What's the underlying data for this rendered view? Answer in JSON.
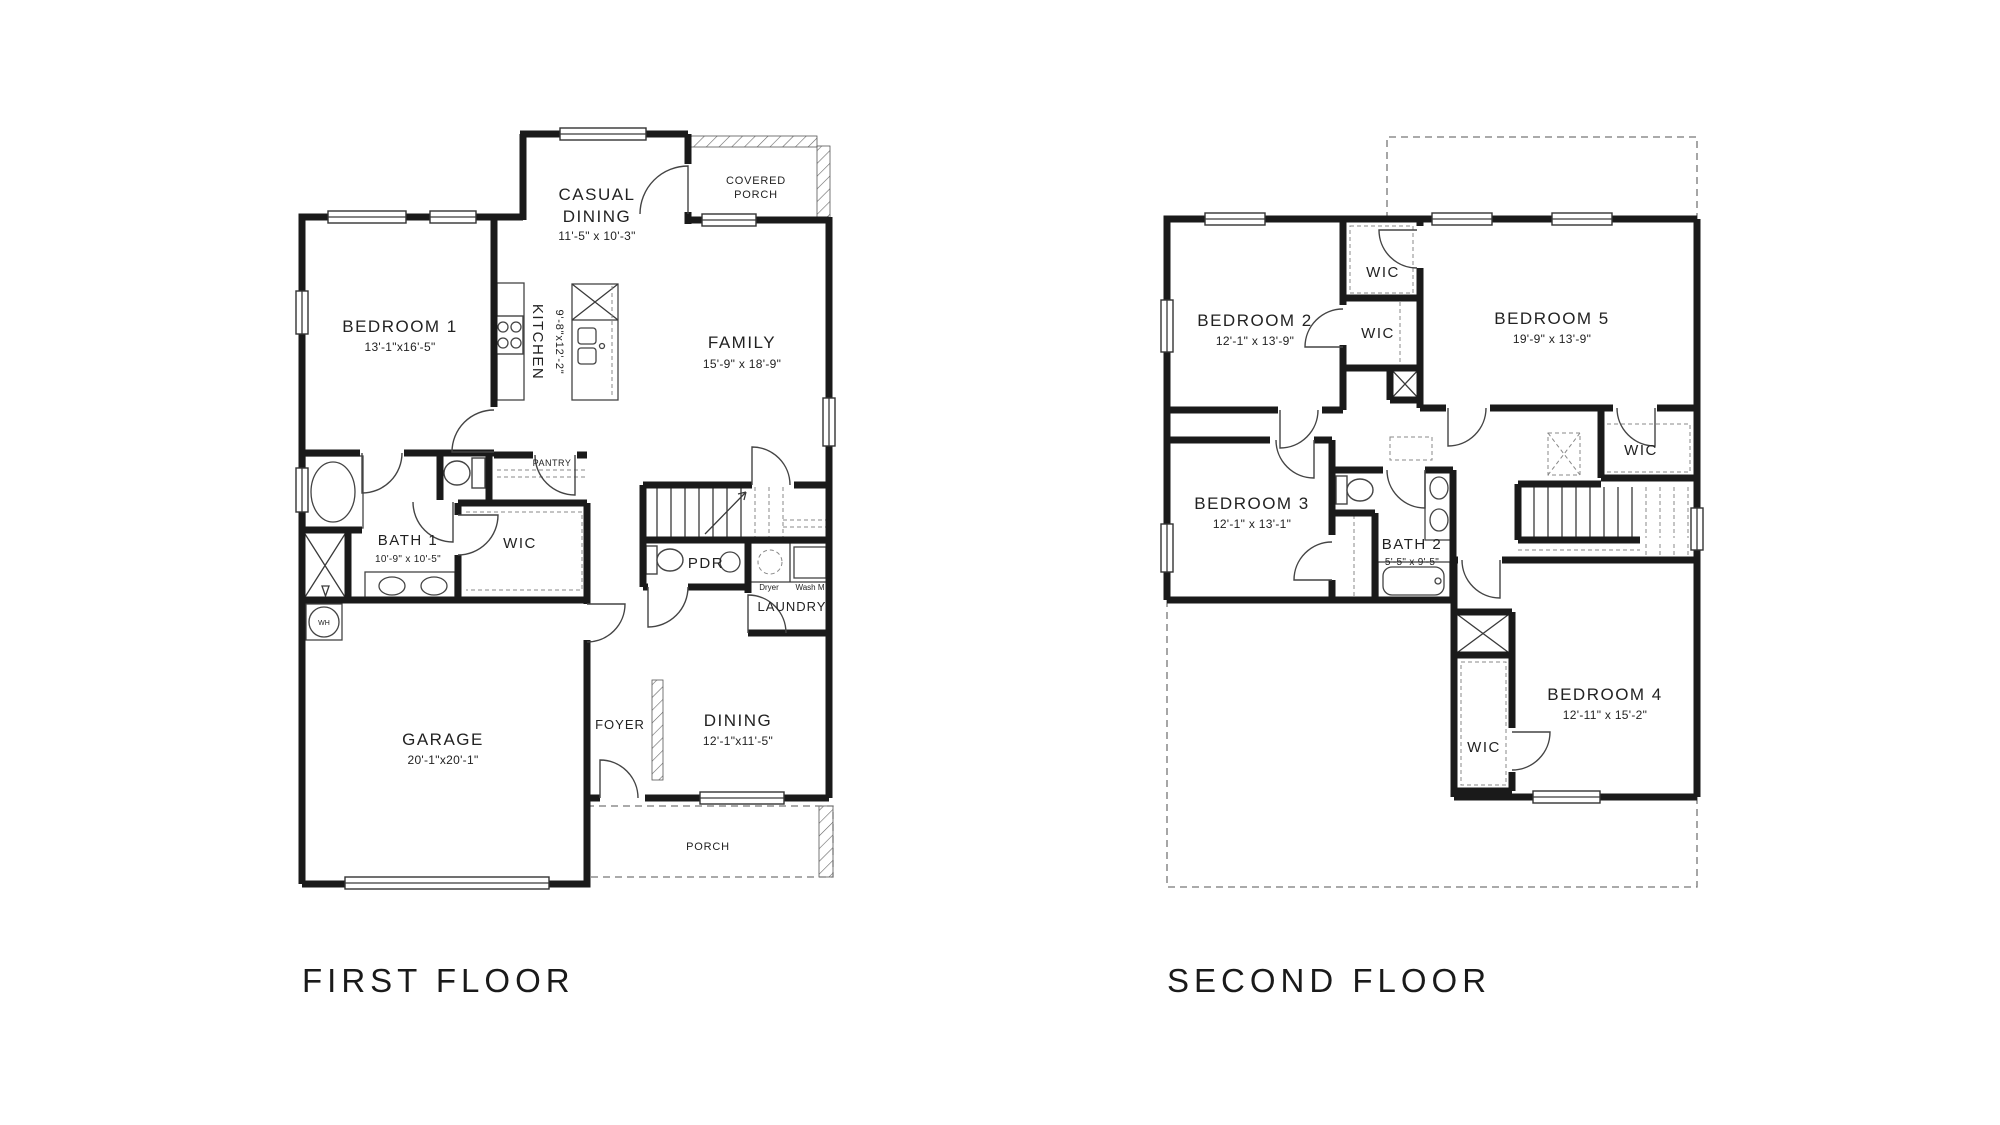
{
  "first_floor": {
    "title": "FIRST FLOOR",
    "rooms": {
      "casual_dining": {
        "line1": "CASUAL",
        "line2": "DINING",
        "dims": "11'-5\" x 10'-3\""
      },
      "covered_porch": {
        "line1": "COVERED",
        "line2": "PORCH"
      },
      "bedroom1": {
        "name": "BEDROOM 1",
        "dims": "13'-1\"x16'-5\""
      },
      "kitchen": {
        "name": "KITCHEN",
        "dims": "9'-8\"x12'-2\""
      },
      "family": {
        "name": "FAMILY",
        "dims": "15'-9\" x 18'-9\""
      },
      "pantry": {
        "name": "PANTRY"
      },
      "bath1": {
        "name": "BATH 1",
        "dims": "10'-9\" x 10'-5\""
      },
      "wic": {
        "name": "WIC"
      },
      "pdr": {
        "name": "PDR"
      },
      "laundry": {
        "name": "LAUNDRY",
        "dryer": "Dryer",
        "washer": "Wash M"
      },
      "garage": {
        "name": "GARAGE",
        "dims": "20'-1\"x20'-1\""
      },
      "water_heater": {
        "name": "WH"
      },
      "foyer": {
        "name": "FOYER"
      },
      "dining": {
        "name": "DINING",
        "dims": "12'-1\"x11'-5\""
      },
      "porch": {
        "name": "PORCH"
      }
    }
  },
  "second_floor": {
    "title": "SECOND FLOOR",
    "rooms": {
      "bedroom2": {
        "name": "BEDROOM 2",
        "dims": "12'-1\" x 13'-9\""
      },
      "bedroom3": {
        "name": "BEDROOM 3",
        "dims": "12'-1\" x 13'-1\""
      },
      "bedroom4": {
        "name": "BEDROOM 4",
        "dims": "12'-11\" x 15'-2\""
      },
      "bedroom5": {
        "name": "BEDROOM 5",
        "dims": "19'-9\" x 13'-9\""
      },
      "bath2": {
        "name": "BATH 2",
        "dims": "5'-5\" x 9'-5\""
      },
      "wic_bedroom5": {
        "name": "WIC"
      },
      "wic_bedroom2": {
        "name": "WIC"
      },
      "wic_hall": {
        "name": "WIC"
      },
      "wic_bedroom4": {
        "name": "WIC"
      }
    }
  },
  "colors": {
    "wall": "#1a1a1a",
    "line": "#3a3a3a",
    "dashed": "#777777",
    "background": "#ffffff"
  }
}
